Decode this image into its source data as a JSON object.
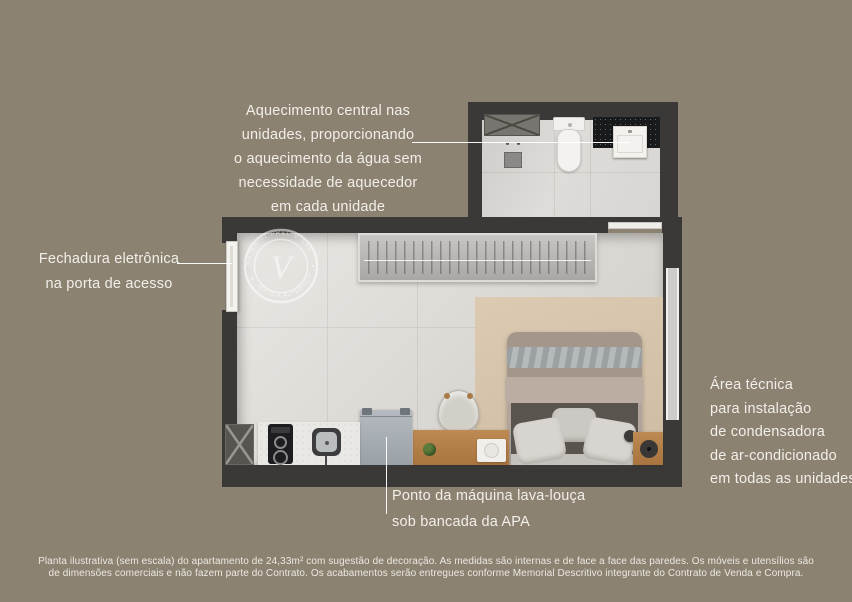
{
  "page": {
    "background_color": "#8b8272",
    "wall_color": "#3b3937",
    "text_color": "#f2efe9",
    "floor_color": "#e2e0dc",
    "rug_color": "#d4c3aa",
    "wood_color": "#b5834f"
  },
  "annotations": {
    "central_heating": {
      "lines": [
        "Aquecimento central nas",
        "unidades, proporcionando",
        "o aquecimento da água sem",
        "necessidade de aquecedor",
        "em cada unidade"
      ]
    },
    "electronic_lock": {
      "lines": [
        "Fechadura eletrônica",
        "na porta de acesso"
      ]
    },
    "technical_area": {
      "lines": [
        "Área técnica",
        "para instalação",
        "de condensadora",
        "de ar-condicionado",
        "em todas as unidades"
      ]
    },
    "dishwasher_point": {
      "lines": [
        "Ponto da máquina lava-louça",
        "sob bancada da APA"
      ]
    }
  },
  "badge": {
    "letter": "V",
    "arc_top": "MATERIAL PRELIMINAR",
    "arc_bottom": "SUJEITO A ALTERAÇÕES"
  },
  "disclaimer": {
    "line1": "Planta ilustrativa (sem escala) do apartamento de 24,33m² com sugestão de decoração. As medidas são internas e de face a face das paredes. Os móveis e utensílios são",
    "line2": "de dimensões comerciais e não fazem parte do Contrato. Os acabamentos serão entregues conforme Memorial Descritivo integrante do Contrato de Venda e Compra."
  }
}
